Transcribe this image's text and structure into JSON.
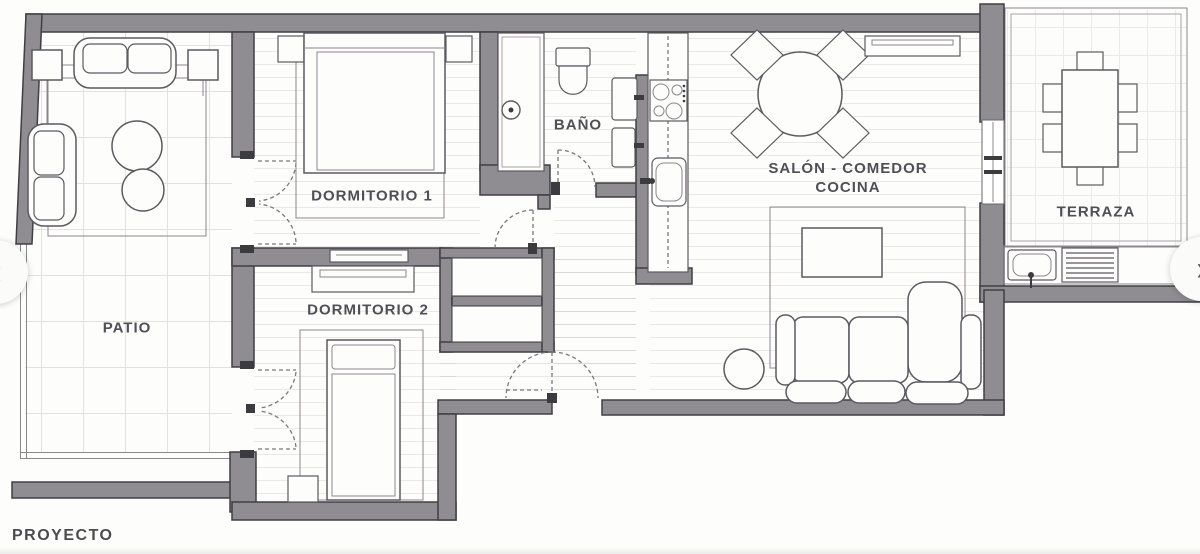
{
  "floor_plan": {
    "rooms": {
      "patio": "PATIO",
      "dormitorio1": "DORMITORIO 1",
      "dormitorio2": "DORMITORIO 2",
      "bano": "BAÑO",
      "salon_line1": "SALÓN - COMEDOR",
      "salon_line2": "COCINA",
      "terraza": "TERRAZA"
    },
    "caption": "PROYECTO"
  },
  "gallery": {
    "prev_glyph": "‹",
    "next_glyph": "›"
  },
  "colors": {
    "wall_fill": "#8F8D91",
    "wall_outline": "#403F44",
    "furniture_line": "#5C5A60",
    "label_text": "#514F56",
    "background": "#FFFFFF"
  }
}
